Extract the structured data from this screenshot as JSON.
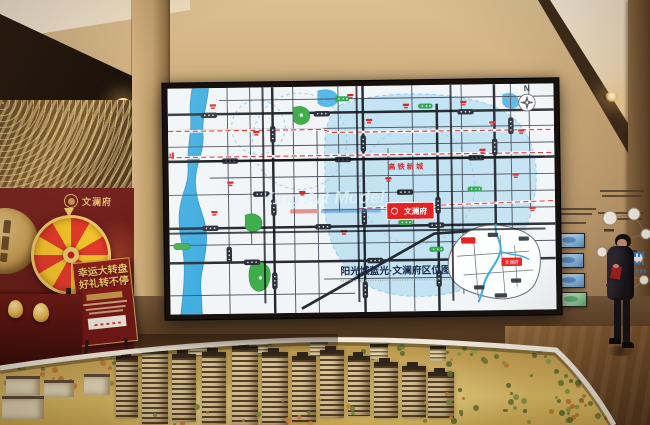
{
  "colors": {
    "accent_red": "#e42222",
    "map_blue": "#3aabdf",
    "district_blue": "#badff2",
    "park_green": "#3fae4a",
    "gold": "#e9c468",
    "wall_tan": "#c9a877",
    "promo_red": "#7c2622"
  },
  "video_wall": {
    "watermark": "King Art Model",
    "compass": "N",
    "district_label": "高铁新城",
    "project_marker": "文澜府",
    "inset_title": "阳光城蓝光·文澜府区位图",
    "inset_marker": "文澜府"
  },
  "promo": {
    "logo_text": "文澜府",
    "sign_line1": "幸运大转盘",
    "sign_line2": "好礼转不停"
  }
}
